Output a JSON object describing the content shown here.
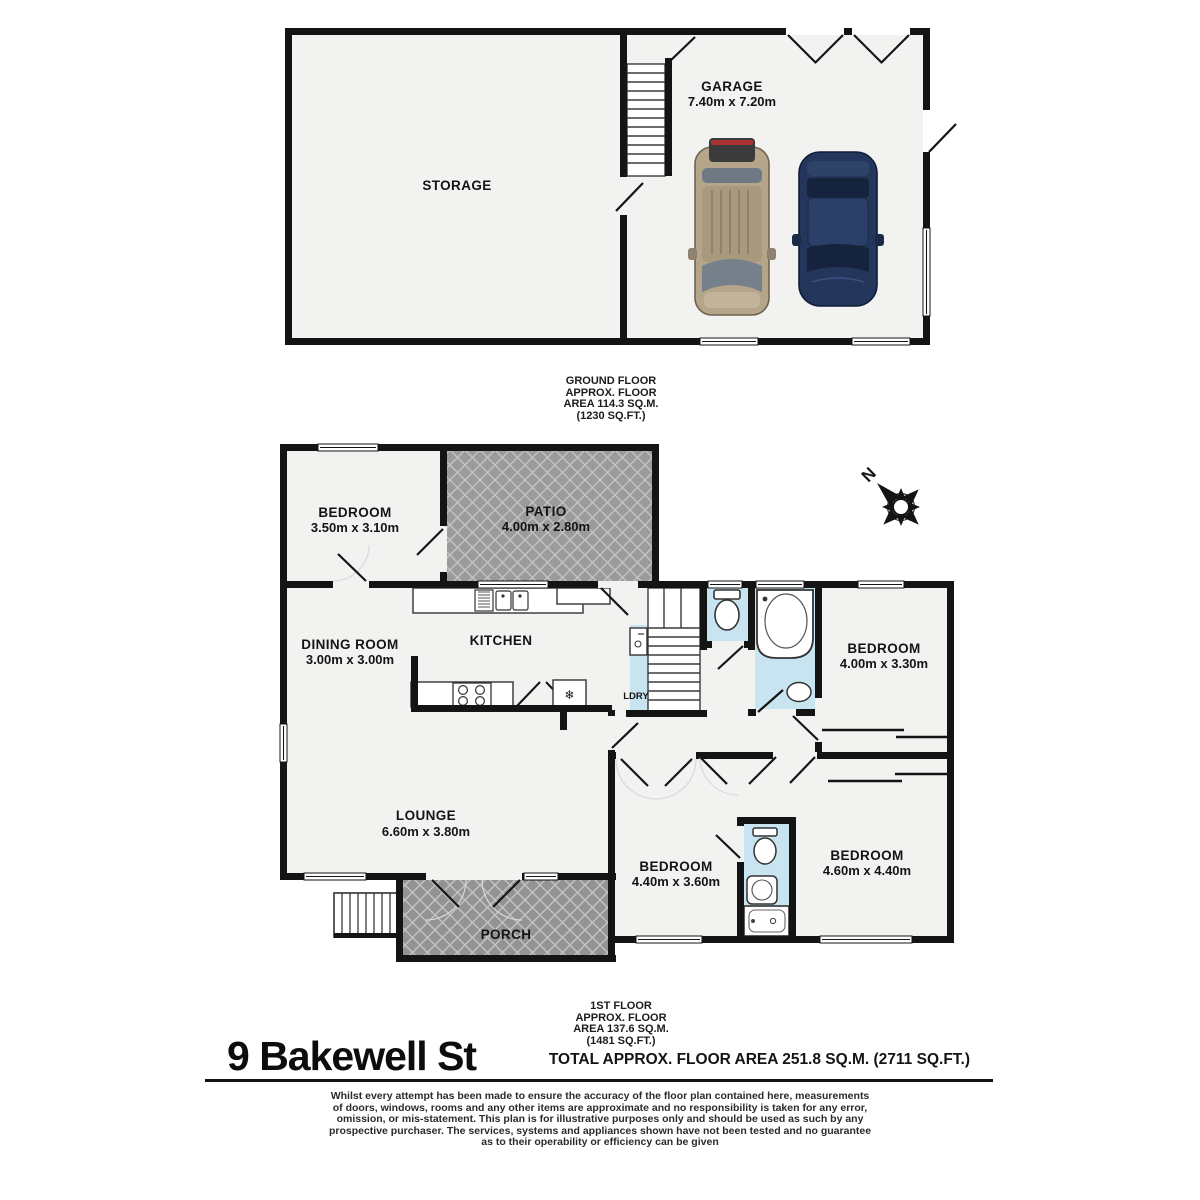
{
  "title": "9 Bakewell St",
  "total_area_label": "TOTAL APPROX. FLOOR AREA 251.8 SQ.M. (2711 SQ.FT.)",
  "compass": {
    "north_label": "N"
  },
  "icons": {
    "freezer_glyph": "❄"
  },
  "ground_floor": {
    "area_label_lines": [
      "GROUND FLOOR",
      "APPROX. FLOOR",
      "AREA 114.3 SQ.M.",
      "(1230 SQ.FT.)"
    ],
    "rooms": {
      "storage": {
        "name": "STORAGE"
      },
      "garage": {
        "name": "GARAGE",
        "dims": "7.40m x 7.20m"
      }
    }
  },
  "first_floor": {
    "area_label_lines": [
      "1ST FLOOR",
      "APPROX. FLOOR",
      "AREA 137.6 SQ.M.",
      "(1481 SQ.FT.)"
    ],
    "rooms": {
      "bedroom_top": {
        "name": "BEDROOM",
        "dims": "3.50m x 3.10m"
      },
      "patio": {
        "name": "PATIO",
        "dims": "4.00m x 2.80m"
      },
      "dining": {
        "name": "DINING ROOM",
        "dims": "3.00m x 3.00m"
      },
      "kitchen": {
        "name": "KITCHEN"
      },
      "laundry": {
        "name": "LDRY"
      },
      "bedroom_right": {
        "name": "BEDROOM",
        "dims": "4.00m x 3.30m"
      },
      "lounge": {
        "name": "LOUNGE",
        "dims": "6.60m x 3.80m"
      },
      "bedroom_bottom_left": {
        "name": "BEDROOM",
        "dims": "4.40m x 3.60m"
      },
      "bedroom_bottom_right": {
        "name": "BEDROOM",
        "dims": "4.60m x 4.40m"
      },
      "porch": {
        "name": "PORCH"
      }
    }
  },
  "disclaimer_lines": [
    "Whilst every attempt has been made to ensure the accuracy of the floor plan contained here, measurements",
    "of doors, windows, rooms and any other items are approximate and no responsibility is taken for any error,",
    "omission, or mis-statement. This plan is for illustrative purposes only and should be used as such by any",
    "prospective purchaser. The services, systems and appliances shown have not been tested and no guarantee",
    "as to their operability or efficiency can be given"
  ],
  "colors": {
    "wall": "#141414",
    "floor": "#f2f2f0",
    "patio_base": "#9b9b9b",
    "hatch_line": "#c4c4c4",
    "bath_blue": "#c9e4f1",
    "car_tan": "#b5a58a",
    "car_blue": "#24365c"
  }
}
